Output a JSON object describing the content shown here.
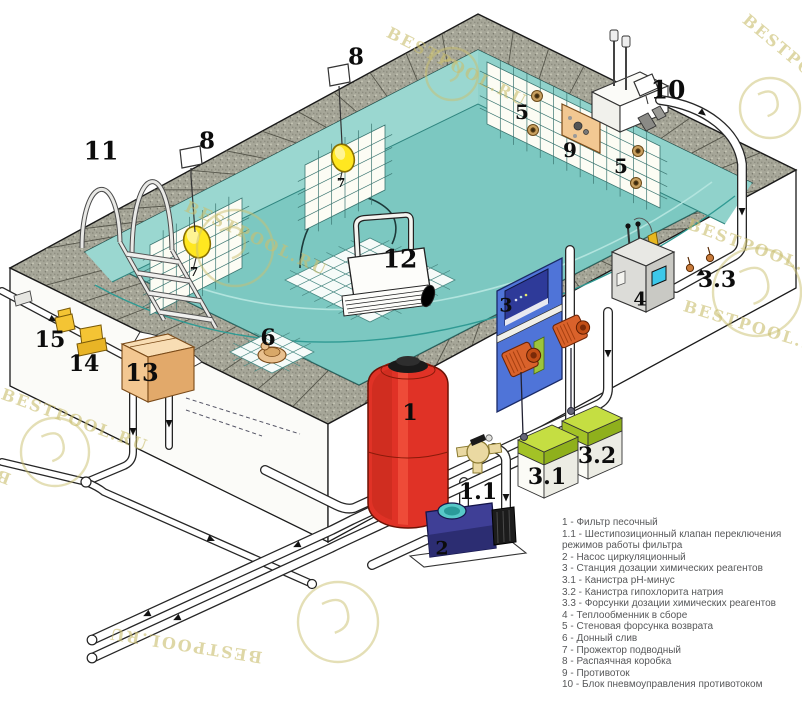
{
  "title": "Схема установки оборудования бассейна",
  "watermark": {
    "text": "BESTPOOL.RU",
    "color": "#cbc070"
  },
  "palette": {
    "water": "#83ccc5",
    "pool_wall": "#9ad7d0",
    "pool_floor": "#7cc8c1",
    "coping": "#a6a698",
    "outer_wall": "#ffffff",
    "outline": "#1a1a1a",
    "filter_red": "#e03226",
    "pump_blue": "#3f3f96",
    "dosing_panel_blue": "#4f74d8",
    "dosing_pump_orange": "#d9622b",
    "heat_exchanger_gray": "#dededa",
    "canister_green": "#b9d53b",
    "skimmer_tan": "#f2c68e",
    "valve_yellow": "#f2c23a",
    "spotlight_yellow": "#ffe720",
    "legend_text": "#57585a"
  },
  "legend": {
    "items": [
      {
        "text": "1 - Фильтр песочный"
      },
      {
        "text": "1.1 - Шестипозиционный клапан переключения режимов работы фильтра"
      },
      {
        "text": "2 - Насос циркуляционный"
      },
      {
        "text": "3 - Станция дозации химических реагентов"
      },
      {
        "text": "3.1 - Канистра pH-минус"
      },
      {
        "text": "3.2 - Канистра гипохлорита натрия"
      },
      {
        "text": "3.3 - Форсунки дозации химических реагентов"
      },
      {
        "text": "4 - Теплообменник в сборе"
      },
      {
        "text": "5 - Стеновая форсунка возврата"
      },
      {
        "text": "6 - Донный слив"
      },
      {
        "text": "7 - Прожектор подводный"
      },
      {
        "text": "8 - Распаячная коробка"
      },
      {
        "text": "9 - Противоток"
      },
      {
        "text": "10 - Блок пневмоуправления противотоком"
      }
    ]
  },
  "callouts": [
    {
      "name": "label-ladder",
      "label": "11",
      "x": 101,
      "y": 151,
      "size": 25
    },
    {
      "name": "label-junction-left",
      "label": "8",
      "x": 207,
      "y": 141,
      "size": 23
    },
    {
      "name": "label-junction-center",
      "label": "8",
      "x": 356,
      "y": 57,
      "size": 23
    },
    {
      "name": "label-light-left",
      "label": "7",
      "x": 194,
      "y": 272,
      "size": 12
    },
    {
      "name": "label-light-center",
      "label": "7",
      "x": 341,
      "y": 183,
      "size": 12
    },
    {
      "name": "label-jet-upper",
      "label": "5",
      "x": 522,
      "y": 112,
      "size": 20
    },
    {
      "name": "label-counterflow",
      "label": "9",
      "x": 570,
      "y": 150,
      "size": 20
    },
    {
      "name": "label-jet-lower",
      "label": "5",
      "x": 621,
      "y": 166,
      "size": 20
    },
    {
      "name": "label-pneumo-block",
      "label": "10",
      "x": 668,
      "y": 90,
      "size": 25
    },
    {
      "name": "label-injectors",
      "label": "3.3",
      "x": 717,
      "y": 280,
      "size": 22
    },
    {
      "name": "label-robot",
      "label": "12",
      "x": 400,
      "y": 259,
      "size": 25
    },
    {
      "name": "label-main-drain",
      "label": "6",
      "x": 268,
      "y": 338,
      "size": 22
    },
    {
      "name": "label-skimmer",
      "label": "13",
      "x": 142,
      "y": 373,
      "size": 24
    },
    {
      "name": "label-valve-14",
      "label": "14",
      "x": 84,
      "y": 364,
      "size": 22
    },
    {
      "name": "label-valve-15",
      "label": "15",
      "x": 50,
      "y": 340,
      "size": 22
    },
    {
      "name": "label-sand-filter",
      "label": "1",
      "x": 410,
      "y": 413,
      "size": 22
    },
    {
      "name": "label-six-way-valve",
      "label": "1.1",
      "x": 478,
      "y": 492,
      "size": 22
    },
    {
      "name": "label-pump",
      "label": "2",
      "x": 442,
      "y": 549,
      "size": 19
    },
    {
      "name": "label-dosing-station",
      "label": "3",
      "x": 506,
      "y": 306,
      "size": 19
    },
    {
      "name": "label-heat-exchanger",
      "label": "4",
      "x": 640,
      "y": 300,
      "size": 19
    },
    {
      "name": "label-canister-ph",
      "label": "3.1",
      "x": 547,
      "y": 477,
      "size": 22
    },
    {
      "name": "label-canister-cl",
      "label": "3.2",
      "x": 597,
      "y": 456,
      "size": 22
    }
  ],
  "watermarks": [
    {
      "text": "BESTPOOL.RU",
      "x": 388,
      "y": 22,
      "rot": 27
    },
    {
      "text": "BESTPOOL.RU",
      "x": 745,
      "y": 8,
      "rot": 40
    },
    {
      "text": "BESTPOOL.RU",
      "x": 688,
      "y": 214,
      "rot": 20
    },
    {
      "text": "BESTPOOL.RU",
      "x": 186,
      "y": 196,
      "rot": 25
    },
    {
      "text": "BESTPOOL.RU",
      "x": 2,
      "y": 384,
      "rot": 20
    },
    {
      "text": "BESTPOOL.RU",
      "x": 10,
      "y": 470,
      "rot": 201
    },
    {
      "text": "BESTPOOL.RU",
      "x": 262,
      "y": 648,
      "rot": 189
    },
    {
      "text": "BESTPOOL.RU",
      "x": 684,
      "y": 296,
      "rot": 17
    }
  ]
}
